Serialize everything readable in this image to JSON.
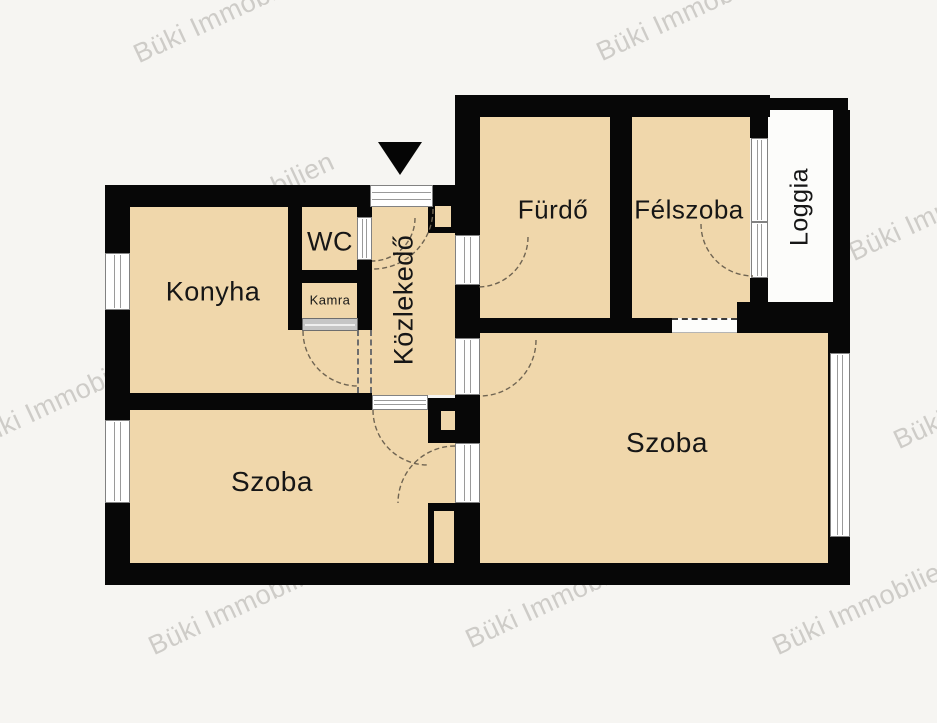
{
  "plan_title": "apartment-floor-plan",
  "rooms": {
    "konyha": "Konyha",
    "wc": "WC",
    "kamra": "Kamra",
    "kozlekedo": "Közlekedő",
    "furdo": "Fürdő",
    "felszoba": "Félszoba",
    "loggia": "Loggia",
    "szoba_left": "Szoba",
    "szoba_right": "Szoba"
  },
  "watermark": {
    "text": "Büki Immobilien"
  },
  "colors": {
    "room_fill": "#f0d7ab",
    "wall": "#070707",
    "background": "#f6f5f2",
    "loggia_fill": "#fcfcfa",
    "watermark": "rgba(150,148,143,0.42)"
  }
}
